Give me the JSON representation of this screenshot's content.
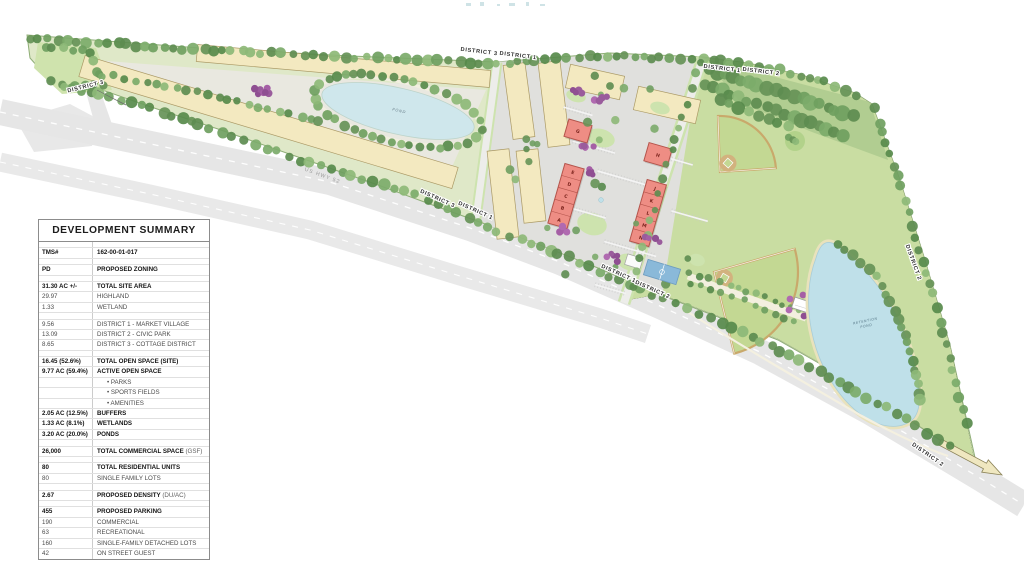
{
  "summary": {
    "title": "DEVELOPMENT SUMMARY",
    "rows": [
      {
        "spacer": true
      },
      {
        "value": "TMS#",
        "label": "162-00-01-017",
        "bold": true
      },
      {
        "spacer": true
      },
      {
        "value": "PD",
        "label": "PROPOSED ZONING",
        "bold": true
      },
      {
        "spacer": true
      },
      {
        "value": "31.30 AC +/-",
        "label": "TOTAL SITE AREA",
        "bold": true
      },
      {
        "value": "29.97",
        "label": "HIGHLAND"
      },
      {
        "value": "1.33",
        "label": "WETLAND"
      },
      {
        "spacer": true
      },
      {
        "value": "9.56",
        "label": "DISTRICT 1 - MARKET VILLAGE"
      },
      {
        "value": "13.09",
        "label": "DISTRICT 2 - CIVIC PARK"
      },
      {
        "value": "8.65",
        "label": "DISTRICT 3 - COTTAGE DISTRICT"
      },
      {
        "spacer": true
      },
      {
        "value": "16.45 (52.6%)",
        "label": "TOTAL OPEN SPACE (SITE)",
        "bold": true
      },
      {
        "value": "9.77 AC (59.4%)",
        "label": "ACTIVE OPEN SPACE",
        "bold": true
      },
      {
        "value": "",
        "label": "PARKS",
        "bullet": true
      },
      {
        "value": "",
        "label": "SPORTS FIELDS",
        "bullet": true
      },
      {
        "value": "",
        "label": "AMENITIES",
        "bullet": true
      },
      {
        "value": "2.05 AC (12.5%)",
        "label": "BUFFERS",
        "bold": true
      },
      {
        "value": "1.33 AC (8.1%)",
        "label": "WETLANDS",
        "bold": true
      },
      {
        "value": "3.20 AC (20.0%)",
        "label": "PONDS",
        "bold": true
      },
      {
        "spacer": true
      },
      {
        "value": "26,000",
        "label": "TOTAL COMMERCIAL SPACE",
        "suffix": " (GSF)",
        "bold": true
      },
      {
        "spacer": true
      },
      {
        "value": "80",
        "label": "TOTAL RESIDENTIAL UNITS",
        "bold": true
      },
      {
        "value": "80",
        "label": "SINGLE FAMILY LOTS"
      },
      {
        "spacer": true
      },
      {
        "value": "2.67",
        "label": "PROPOSED DENSITY",
        "suffix": " (DU/AC)",
        "bold": true
      },
      {
        "spacer": true
      },
      {
        "value": "455",
        "label": "PROPOSED PARKING",
        "bold": true
      },
      {
        "value": "190",
        "label": "COMMERCIAL"
      },
      {
        "value": "63",
        "label": "RECREATIONAL"
      },
      {
        "value": "160",
        "label": "SINGLE-FAMILY DETACHED LOTS"
      },
      {
        "value": "42",
        "label": "ON STREET GUEST"
      }
    ]
  },
  "map": {
    "road": {
      "highway": "US HWY 52"
    },
    "district_labels": [
      {
        "text": "DISTRICT 3",
        "x": 86,
        "y": 88,
        "rot": -14,
        "callout": true
      },
      {
        "text": "DISTRICT 3",
        "x": 479,
        "y": 53,
        "rot": 7
      },
      {
        "text": "DISTRICT 1",
        "x": 518,
        "y": 57,
        "rot": 7
      },
      {
        "text": "DISTRICT 1",
        "x": 722,
        "y": 70,
        "rot": 7
      },
      {
        "text": "DISTRICT 2",
        "x": 761,
        "y": 73,
        "rot": 7
      },
      {
        "text": "DISTRICT 3",
        "x": 437,
        "y": 200,
        "rot": 24
      },
      {
        "text": "DISTRICT 1",
        "x": 475,
        "y": 212,
        "rot": 24
      },
      {
        "text": "DISTRICT 1",
        "x": 618,
        "y": 275,
        "rot": 24
      },
      {
        "text": "DISTRICT 2",
        "x": 652,
        "y": 291,
        "rot": 24
      },
      {
        "text": "DISTRICT 2",
        "x": 912,
        "y": 263,
        "rot": 70
      },
      {
        "text": "DISTRICT 2",
        "x": 927,
        "y": 456,
        "rot": 35
      }
    ],
    "lots": {
      "cottage_row_front": [
        "1",
        "2",
        "3",
        "4",
        "5",
        "6",
        "7",
        "8",
        "9",
        "10",
        "11",
        "12",
        "13",
        "14",
        "15",
        "16",
        "17",
        "18",
        "19",
        "20",
        "21",
        "22",
        "23",
        "24",
        "25",
        "26",
        "27",
        "28",
        "29",
        "30"
      ],
      "cottage_row_back": [
        "52",
        "51",
        "50",
        "49",
        "48",
        "47",
        "46",
        "45",
        "44",
        "43",
        "42",
        "41",
        "40",
        "39",
        "38",
        "37",
        "36",
        "35",
        "34",
        "33",
        "32",
        "31"
      ],
      "village_col_a_top": [
        "53a",
        "54a",
        "55a",
        "56a",
        "57a"
      ],
      "village_col_a_bottom": [
        "58a",
        "59a",
        "60a",
        "61a",
        "62a",
        "63a"
      ],
      "village_col_b_top": [
        "72b",
        "71b",
        "70b",
        "69b",
        "68b"
      ],
      "village_col_b_bottom": [
        "67b",
        "66b",
        "65b",
        "64b"
      ],
      "villa_row_1": [
        "73v",
        "74v",
        "75v",
        "76v"
      ],
      "villa_row_2": [
        "77v",
        "78v",
        "79v",
        "80v"
      ]
    },
    "buildings": {
      "pads": [
        "G",
        "H"
      ],
      "west_strip": [
        "E",
        "D",
        "C",
        "B",
        "A"
      ],
      "east_strip": [
        "J",
        "K",
        "L",
        "M",
        "N"
      ]
    },
    "ponds": {
      "amenity_pond": "POND",
      "retention_pond": [
        "RETENTION",
        "POND"
      ]
    },
    "colors": {
      "site_green": "#dfe8c8",
      "park_green": "#c9dda2",
      "lot_yellow": "#f3e9c0",
      "building_red": "#ee8d84",
      "pond_blue": "#bfe0e9",
      "road_gray": "#e6e6e6",
      "tree_green": "#6f9f60",
      "ornamental_purple": "#9a5c9c"
    }
  }
}
